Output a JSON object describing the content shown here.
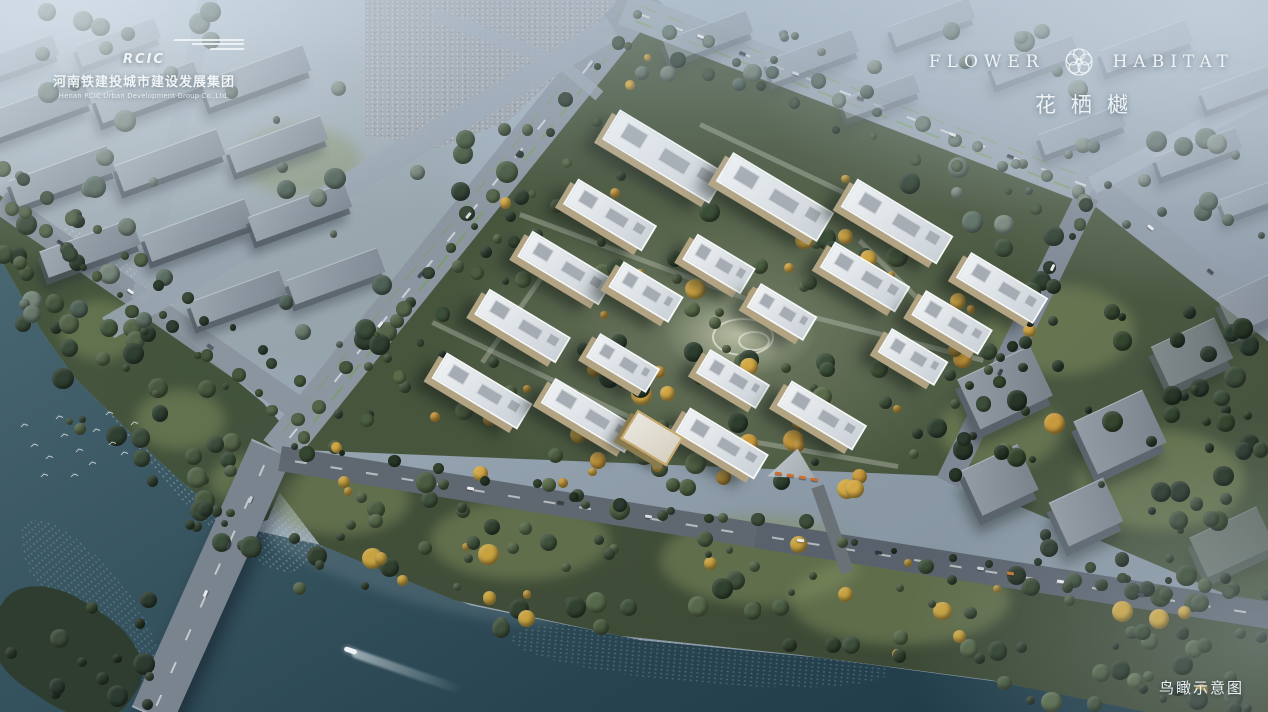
{
  "branding": {
    "developer": {
      "logo_text": "RCIC",
      "name_cn": "河南铁建投城市建设发展集团",
      "name_en": "Henan RCIC Urban Development Group Co.,Ltd."
    },
    "project": {
      "name_left": "FLOWER",
      "name_right": "HABITAT",
      "name_cn": "花栖樾",
      "icon": "camellia-flower-icon"
    }
  },
  "caption": {
    "text": "鸟瞰示意图"
  },
  "colors": {
    "water_deep": "#1e3947",
    "water_light": "#56757f",
    "foliage": "#3f5140",
    "foliage_autumn": "#d2a844",
    "road": "#8b96a1",
    "tower_roof": "#eff2f4",
    "tower_facade": "#b2a383",
    "haze": "#c6d5e2"
  },
  "scene": {
    "palettes": {
      "greens": [
        "#3a4c3a",
        "#46593f",
        "#54654a",
        "#2f3f31"
      ],
      "dark": [
        "#2c3b2f",
        "#35462f",
        "#273627",
        "#3d4d3b"
      ],
      "park": [
        "#3f513c",
        "#4a5c41",
        "#31412f",
        "#56684a",
        "#c7a23f"
      ],
      "comp": [
        "#3c4f39",
        "#4c5e41",
        "#d2a844",
        "#c99a3c",
        "#2f4030",
        "#5a6b4a"
      ],
      "hazy": [
        "#5c6f63",
        "#68796c",
        "#4e6156",
        "#76867a"
      ]
    },
    "lawns": [
      [
        1060,
        330,
        150,
        90
      ],
      [
        1160,
        480,
        170,
        100
      ],
      [
        1000,
        430,
        120,
        80
      ],
      [
        760,
        560,
        200,
        90
      ],
      [
        520,
        540,
        180,
        80
      ],
      [
        340,
        500,
        140,
        70
      ],
      [
        900,
        600,
        220,
        90
      ],
      [
        300,
        160,
        120,
        70
      ],
      [
        100,
        330,
        80,
        60
      ],
      [
        180,
        420,
        90,
        60
      ],
      [
        250,
        480,
        80,
        50
      ]
    ],
    "roads": [
      [
        152,
        716,
        272,
        448,
        44,
        "#79848f",
        1,
        1,
        0
      ],
      [
        278,
        452,
        648,
        -8,
        38,
        "#8b96a1",
        1,
        1,
        1
      ],
      [
        624,
        8,
        1102,
        192,
        34,
        "#96a3ae",
        1,
        1,
        1
      ],
      [
        1094,
        188,
        1276,
        330,
        28,
        "#8c98a4",
        1,
        0,
        0
      ],
      [
        1088,
        195,
        948,
        482,
        24,
        "#7e8894",
        1,
        0,
        0
      ],
      [
        280,
        458,
        764,
        536,
        25,
        "#5f6871",
        1,
        1,
        0
      ],
      [
        756,
        534,
        1276,
        616,
        27,
        "#59626c",
        1,
        1,
        0
      ],
      [
        0,
        202,
        312,
        418,
        24,
        "#8a949e",
        0.95,
        0,
        0
      ],
      [
        108,
        328,
        612,
        28,
        24,
        "#98a4b0",
        0.9,
        0,
        0
      ],
      [
        210,
        -8,
        140,
        300,
        18,
        "#9aa6b2",
        0.7,
        0,
        0
      ],
      [
        1092,
        185,
        1276,
        88,
        18,
        "#a2aeba",
        0.8,
        0,
        0
      ],
      [
        432,
        14,
        560,
        62,
        13,
        "#99a5b1",
        0.85,
        0,
        0
      ],
      [
        558,
        60,
        600,
        96,
        12,
        "#99a5b1",
        0.8,
        0,
        0
      ],
      [
        818,
        486,
        848,
        572,
        13,
        "#6a7278",
        1,
        0,
        0
      ]
    ],
    "paths": [
      [
        432,
        322,
        640,
        422
      ],
      [
        640,
        422,
        898,
        466
      ],
      [
        520,
        214,
        756,
        302
      ],
      [
        756,
        302,
        984,
        360
      ],
      [
        700,
        124,
        928,
        232
      ],
      [
        482,
        362,
        560,
        250
      ],
      [
        860,
        240,
        940,
        320
      ]
    ],
    "slabs": [
      [
        40,
        108,
        100,
        28,
        1
      ],
      [
        148,
        92,
        106,
        28,
        1
      ],
      [
        256,
        76,
        108,
        28,
        0.95
      ],
      [
        62,
        176,
        104,
        28,
        1
      ],
      [
        170,
        160,
        108,
        28,
        1
      ],
      [
        278,
        144,
        98,
        26,
        0.95
      ],
      [
        90,
        248,
        98,
        28,
        1
      ],
      [
        198,
        230,
        108,
        28,
        1
      ],
      [
        300,
        212,
        102,
        26,
        0.95
      ],
      [
        238,
        298,
        96,
        26,
        0.95
      ],
      [
        336,
        276,
        96,
        26,
        0.9
      ],
      [
        708,
        36,
        88,
        24,
        0.6
      ],
      [
        812,
        56,
        92,
        24,
        0.6
      ],
      [
        932,
        22,
        84,
        22,
        0.55
      ],
      [
        1034,
        60,
        88,
        22,
        0.6
      ],
      [
        1146,
        46,
        92,
        24,
        0.6
      ],
      [
        1242,
        86,
        82,
        22,
        0.6
      ],
      [
        1082,
        130,
        86,
        22,
        0.65
      ],
      [
        1198,
        152,
        86,
        22,
        0.65
      ],
      [
        880,
        96,
        78,
        20,
        0.55
      ],
      [
        1258,
        196,
        76,
        20,
        0.6
      ],
      [
        18,
        58,
        80,
        22,
        0.5
      ],
      [
        118,
        42,
        84,
        22,
        0.5
      ]
    ],
    "boxes": [
      [
        1005,
        387,
        80,
        55,
        1
      ],
      [
        1120,
        432,
        76,
        58,
        1
      ],
      [
        1000,
        480,
        62,
        50,
        1
      ],
      [
        1086,
        512,
        60,
        48,
        1
      ],
      [
        1192,
        352,
        70,
        45,
        0.75
      ],
      [
        1256,
        302,
        68,
        40,
        0.6
      ],
      [
        1232,
        542,
        74,
        44,
        0.5
      ]
    ],
    "trees": [
      {
        "x": 0,
        "y": 210,
        "w": 90,
        "h": 140,
        "n": 14,
        "p": "greens",
        "s": 11
      },
      {
        "x": 60,
        "y": 300,
        "w": 100,
        "h": 150,
        "n": 16,
        "p": "greens",
        "s": 12
      },
      {
        "x": 130,
        "y": 380,
        "w": 110,
        "h": 150,
        "n": 16,
        "p": "greens",
        "s": 13
      },
      {
        "x": 0,
        "y": 600,
        "w": 150,
        "h": 105,
        "n": 14,
        "p": "dark",
        "s": 14
      },
      {
        "x": 190,
        "y": 430,
        "w": 110,
        "h": 120,
        "n": 12,
        "p": "greens",
        "s": 15
      },
      {
        "x": 290,
        "y": 470,
        "w": 210,
        "h": 120,
        "n": 24,
        "p": "park",
        "s": 16
      },
      {
        "x": 470,
        "y": 505,
        "w": 260,
        "h": 125,
        "n": 28,
        "p": "park",
        "s": 17
      },
      {
        "x": 700,
        "y": 535,
        "w": 280,
        "h": 125,
        "n": 28,
        "p": "park",
        "s": 18
      },
      {
        "x": 950,
        "y": 570,
        "w": 280,
        "h": 135,
        "n": 28,
        "p": "park",
        "s": 19
      },
      {
        "x": 1110,
        "y": 630,
        "w": 158,
        "h": 80,
        "n": 16,
        "p": "dark",
        "s": 20
      },
      {
        "x": 440,
        "y": 150,
        "w": 280,
        "h": 260,
        "n": 24,
        "p": "comp",
        "s": 21
      },
      {
        "x": 590,
        "y": 240,
        "w": 290,
        "h": 160,
        "n": 24,
        "p": "comp",
        "s": 22
      },
      {
        "x": 540,
        "y": 345,
        "w": 300,
        "h": 140,
        "n": 18,
        "p": "comp",
        "s": 23
      },
      {
        "x": 790,
        "y": 170,
        "w": 270,
        "h": 210,
        "n": 22,
        "p": "comp",
        "s": 24
      },
      {
        "x": 880,
        "y": 280,
        "w": 180,
        "h": 180,
        "n": 18,
        "p": "comp",
        "s": 25
      },
      {
        "x": 430,
        "y": 380,
        "w": 260,
        "h": 120,
        "n": 16,
        "p": "comp",
        "s": 26
      },
      {
        "x": 650,
        "y": 415,
        "w": 300,
        "h": 95,
        "n": 16,
        "p": "comp",
        "s": 27
      },
      {
        "x": 960,
        "y": 300,
        "w": 300,
        "h": 160,
        "n": 26,
        "p": "dark",
        "s": 28
      },
      {
        "x": 1000,
        "y": 440,
        "w": 260,
        "h": 160,
        "n": 24,
        "p": "dark",
        "s": 29
      },
      {
        "x": 1150,
        "y": 350,
        "w": 120,
        "h": 200,
        "n": 16,
        "p": "dark",
        "s": 30
      },
      {
        "x": 0,
        "y": 80,
        "w": 430,
        "h": 270,
        "n": 30,
        "p": "hazy",
        "s": 31
      },
      {
        "x": 640,
        "y": 30,
        "w": 440,
        "h": 70,
        "n": 18,
        "p": "hazy",
        "s": 32
      },
      {
        "x": 1060,
        "y": 120,
        "w": 210,
        "h": 120,
        "n": 14,
        "p": "hazy",
        "s": 33
      },
      {
        "x": 950,
        "y": 150,
        "w": 200,
        "h": 90,
        "n": 10,
        "p": "hazy",
        "s": 34
      },
      {
        "x": 330,
        "y": 300,
        "w": 90,
        "h": 150,
        "n": 12,
        "p": "greens",
        "s": 35
      },
      {
        "x": 440,
        "y": 120,
        "w": 110,
        "h": 150,
        "n": 10,
        "p": "greens",
        "s": 36
      },
      {
        "x": 0,
        "y": 0,
        "w": 220,
        "h": 80,
        "n": 10,
        "p": "hazy",
        "s": 38
      }
    ],
    "treelines": [
      [
        8,
        168,
        300,
        380,
        14,
        "greens",
        41
      ],
      [
        5,
        205,
        290,
        420,
        16,
        "greens",
        42
      ],
      [
        300,
        430,
        620,
        40,
        14,
        "greens",
        43
      ],
      [
        336,
        452,
        652,
        52,
        12,
        "comp",
        44
      ],
      [
        640,
        16,
        1088,
        196,
        14,
        "hazy",
        45
      ],
      [
        634,
        44,
        1082,
        222,
        12,
        "greens",
        46
      ],
      [
        300,
        448,
        1268,
        602,
        22,
        "dark",
        47
      ],
      [
        1082,
        212,
        958,
        468,
        10,
        "dark",
        48
      ]
    ],
    "buildings": [
      [
        664,
        156,
        125,
        35
      ],
      [
        775,
        197,
        118,
        34
      ],
      [
        897,
        221,
        112,
        33
      ],
      [
        1002,
        288,
        90,
        30
      ],
      [
        610,
        215,
        92,
        30
      ],
      [
        565,
        268,
        95,
        30
      ],
      [
        522,
        326,
        95,
        30
      ],
      [
        482,
        391,
        100,
        30
      ],
      [
        719,
        264,
        68,
        30
      ],
      [
        646,
        292,
        70,
        30
      ],
      [
        865,
        277,
        88,
        30
      ],
      [
        952,
        322,
        78,
        29
      ],
      [
        782,
        312,
        66,
        28
      ],
      [
        623,
        363,
        70,
        28
      ],
      [
        733,
        379,
        70,
        28
      ],
      [
        822,
        415,
        88,
        29
      ],
      [
        913,
        357,
        66,
        28
      ],
      [
        590,
        415,
        98,
        29
      ],
      [
        722,
        443,
        92,
        29
      ]
    ],
    "amenity": [
      652,
      438,
      54,
      34
    ],
    "triangle_building": [
      793,
      464
    ],
    "cars": [
      [
        700,
        37,
        21,
        "#e8eaec"
      ],
      [
        742,
        54,
        21,
        "#3a4048"
      ],
      [
        795,
        74,
        21,
        "#c9ccd0"
      ],
      [
        860,
        99,
        21,
        "#555c64"
      ],
      [
        952,
        135,
        21,
        "#e8eaec"
      ],
      [
        1010,
        157,
        21,
        "#3a4048"
      ],
      [
        380,
        325,
        -51,
        "#e8eaec"
      ],
      [
        420,
        275,
        -51,
        "#444a52"
      ],
      [
        468,
        216,
        -51,
        "#d7dadd"
      ],
      [
        518,
        154,
        -51,
        "#30363e"
      ],
      [
        590,
        64,
        -51,
        "#c9ccd0"
      ],
      [
        205,
        594,
        -66,
        "#e8eaec"
      ],
      [
        228,
        546,
        -66,
        "#3a4048"
      ],
      [
        250,
        500,
        -66,
        "#c9ccd0"
      ],
      [
        470,
        489,
        9,
        "#e8eaec"
      ],
      [
        560,
        503,
        9,
        "#3a4048"
      ],
      [
        648,
        517,
        9,
        "#d7dadd"
      ],
      [
        800,
        541,
        9,
        "#e8eaec"
      ],
      [
        878,
        553,
        9,
        "#30363e"
      ],
      [
        980,
        569,
        9,
        "#c9ccd0"
      ],
      [
        1060,
        582,
        9,
        "#e8eaec"
      ],
      [
        1140,
        595,
        9,
        "#3a4048"
      ],
      [
        1010,
        574,
        9,
        "#c9742e"
      ],
      [
        60,
        243,
        35,
        "#3a4048"
      ],
      [
        130,
        292,
        35,
        "#e8eaec"
      ],
      [
        210,
        347,
        35,
        "#555c64"
      ],
      [
        1052,
        268,
        116,
        "#e8eaec"
      ],
      [
        1000,
        373,
        116,
        "#3a4048"
      ],
      [
        1150,
        228,
        38,
        "#e8eaec"
      ],
      [
        1210,
        272,
        38,
        "#444a52"
      ],
      [
        778,
        474,
        10,
        "#cd6f2f"
      ],
      [
        790,
        476,
        10,
        "#cd6f2f"
      ],
      [
        802,
        478,
        10,
        "#cd6f2f"
      ],
      [
        814,
        480,
        10,
        "#cd6f2f"
      ]
    ],
    "birds": [
      [
        30,
        440
      ],
      [
        45,
        452
      ],
      [
        60,
        430
      ],
      [
        75,
        445
      ],
      [
        88,
        458
      ],
      [
        55,
        412
      ],
      [
        92,
        425
      ],
      [
        108,
        438
      ],
      [
        120,
        448
      ],
      [
        70,
        470
      ],
      [
        40,
        470
      ],
      [
        130,
        418
      ],
      [
        105,
        408
      ],
      [
        20,
        420
      ]
    ],
    "boat": {
      "x": 344,
      "y": 648
    }
  }
}
